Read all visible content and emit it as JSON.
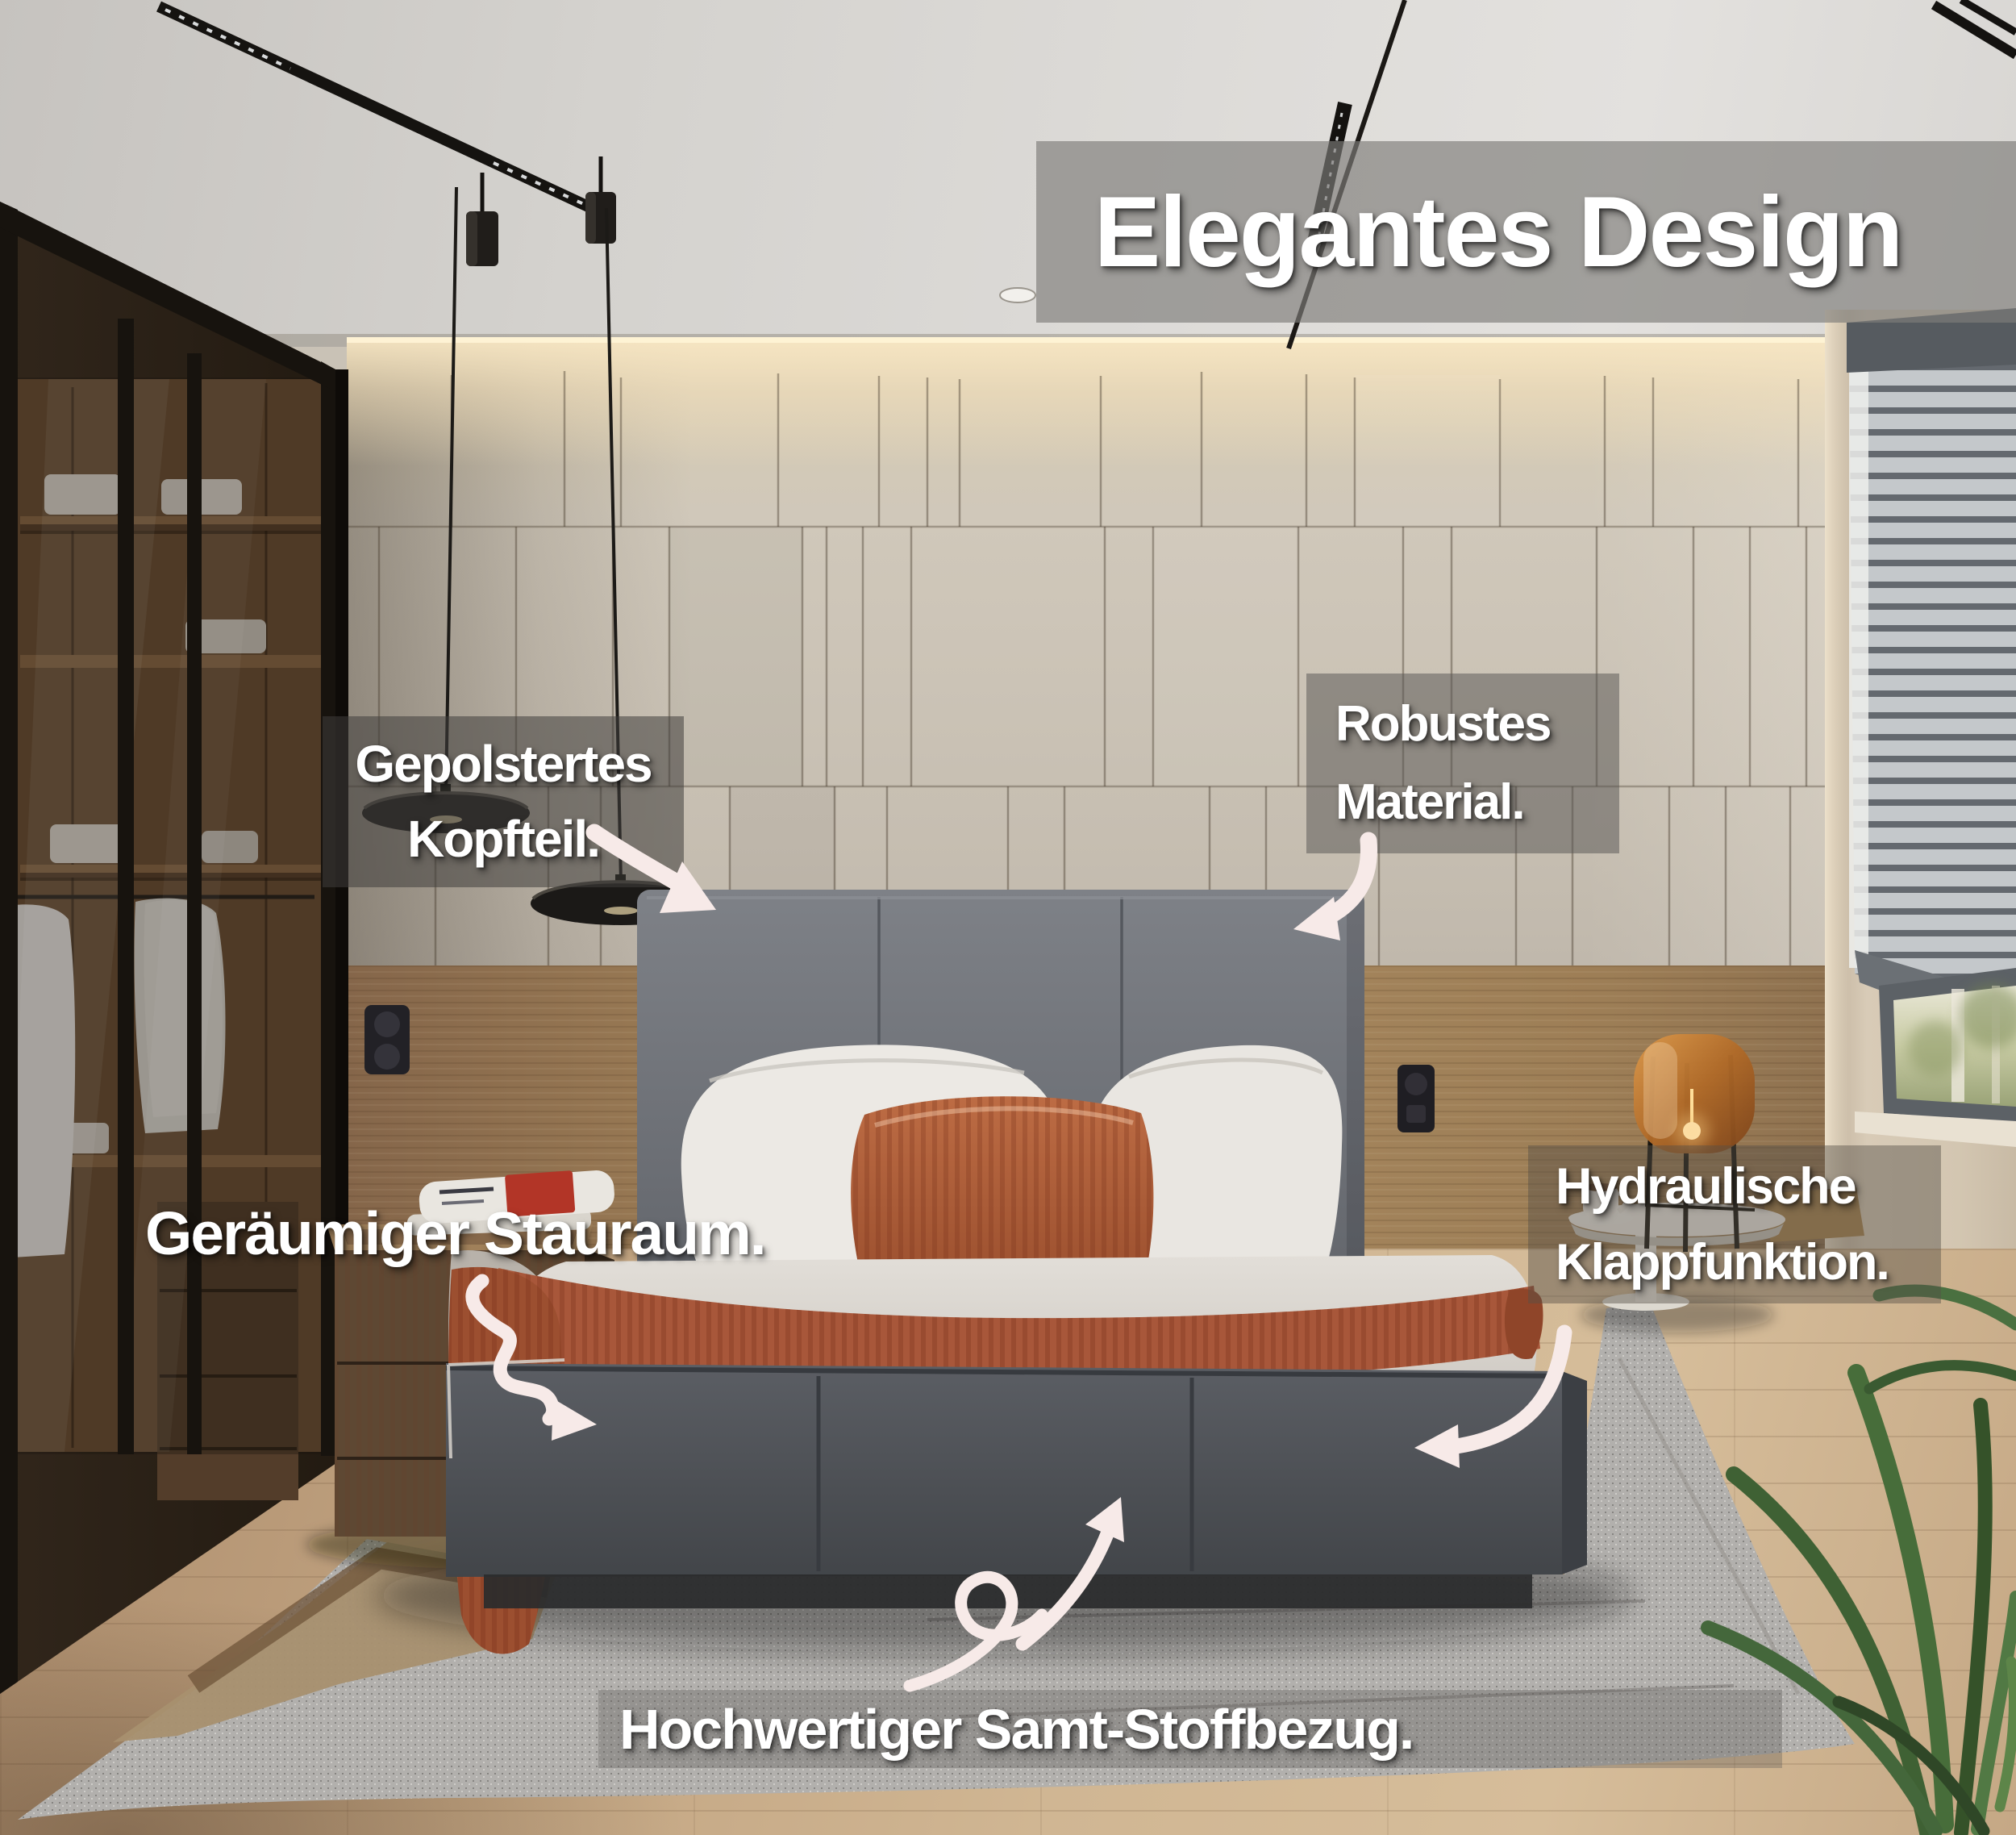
{
  "title": {
    "label": "Elegantes Design"
  },
  "annotations": {
    "headboard": {
      "line1": "Gepolstertes",
      "line2": "Kopfteil."
    },
    "material": {
      "line1": "Robustes",
      "line2": "Material."
    },
    "storage": {
      "label": "Geräumiger Stauraum."
    },
    "hydraulic": {
      "line1": "Hydraulische",
      "line2": "Klappfunktion."
    },
    "fabric": {
      "label": "Hochwertiger Samt-Stoffbezug."
    }
  },
  "icons": {
    "annotation_arrows": [
      "arrow-headboard-icon",
      "arrow-material-icon",
      "arrow-storage-icon",
      "arrow-hydraulic-icon",
      "arrow-fabric-icon"
    ],
    "heart": "heart-icon"
  },
  "colors": {
    "label_text": "#ffffff",
    "overlay_gray": "rgba(110,108,105,0.6)",
    "arrow": "#f7eae8",
    "bed_velvet_gray": "#55585d",
    "accent_terracotta": "#b0613c"
  }
}
